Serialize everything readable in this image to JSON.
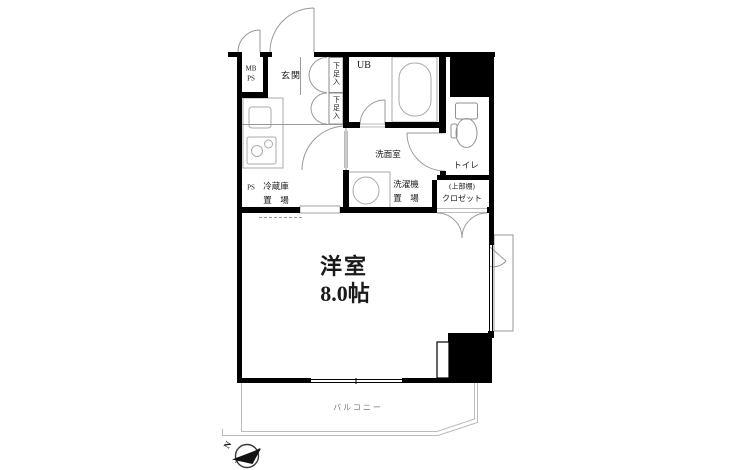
{
  "floorplan": {
    "labels": {
      "main_room": "洋室",
      "main_room_size": "8.0帖",
      "entrance": "玄関",
      "meter_box": "MB",
      "pipe_space_top": "PS",
      "pipe_space": "PS",
      "shoe_storage": "下足入",
      "unit_bath": "UB",
      "washroom": "洗面室",
      "toilet": "トイレ",
      "closet_shelf_note": "(上部棚)",
      "closet": "クロゼット",
      "fridge_space_line1": "冷蔵庫",
      "fridge_space_line2": "置　場",
      "washer_space_line1": "洗濯機",
      "washer_space_line2": "置　場",
      "balcony": "バルコニー",
      "compass_north": "N"
    },
    "colors": {
      "wall": "#000000",
      "fixture_line": "#aaaaaa",
      "door_line": "#999999",
      "balcony_line": "#bbbbbb",
      "text": "#1a1a1a",
      "balcony_text": "#777777",
      "background": "#ffffff"
    }
  }
}
